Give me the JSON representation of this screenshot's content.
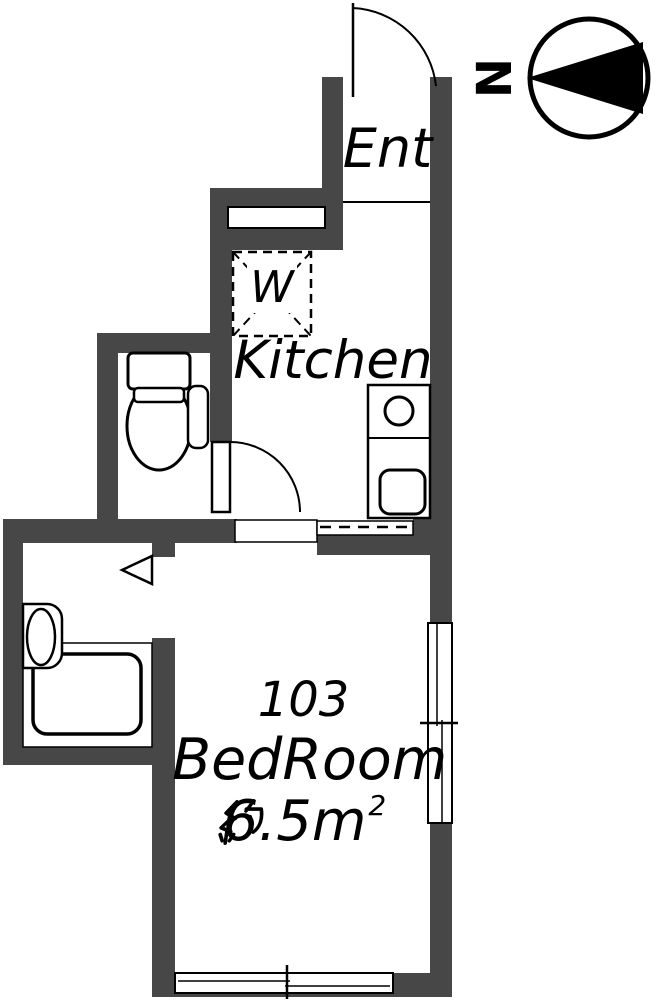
{
  "compass": {
    "north_label": "N"
  },
  "labels": {
    "entrance": "Ent",
    "kitchen": "Kitchen",
    "washer": "W",
    "room_number": "103",
    "room_name": "BedRoom",
    "room_area": "約6.5m²",
    "room_area_prefix": "約",
    "room_area_value": "6.5m",
    "room_area_sup": "2"
  },
  "colors": {
    "wall": "#474747",
    "line": "#000000",
    "background": "#ffffff"
  }
}
